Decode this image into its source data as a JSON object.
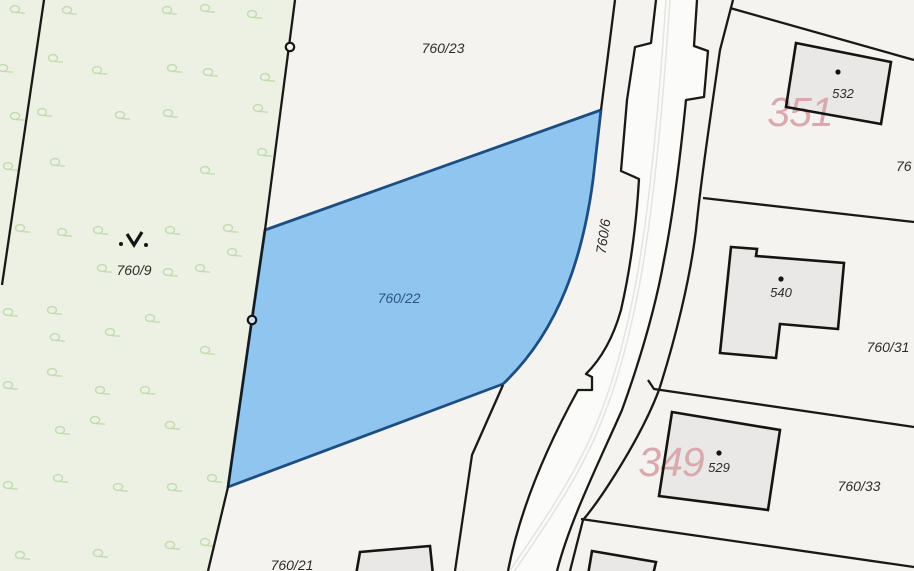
{
  "map": {
    "description": "cadastral parcel map view",
    "selected_parcel": "760/22",
    "colors": {
      "background": "#f4f3f0",
      "forest_fill": "#ecf1e4",
      "forest_symbol": "#c3dbb0",
      "selected_fill": "#8fc5ee",
      "selected_stroke": "#1c4e82",
      "boundary_line": "#191917",
      "building_fill": "#e9e8e6",
      "road_fill": "#fbfbf9",
      "road_centerline": "#e4e4e0",
      "sheet_label_pink": "#d9a9ad",
      "label_black": "#2c2c29",
      "label_blue": "#2e5584"
    },
    "parcels": {
      "p760_23": "760/23",
      "p760_9": "760/9",
      "p760_22": "760/22",
      "p760_6": "760/6",
      "p760_21": "760/21",
      "p760_31": "760/31",
      "p760_33": "760/33",
      "p_edge_cut": "76"
    },
    "buildings": {
      "b532": "532",
      "b540": "540",
      "b529": "529"
    },
    "map_sheets": {
      "s351": "351",
      "s349": "349"
    },
    "vegetation": {
      "meadow_marker": [
        135,
        241
      ],
      "positions": [
        [
          15,
          9
        ],
        [
          67,
          10
        ],
        [
          167,
          10
        ],
        [
          205,
          8
        ],
        [
          252,
          14
        ],
        [
          3,
          68
        ],
        [
          53,
          58
        ],
        [
          97,
          70
        ],
        [
          172,
          68
        ],
        [
          208,
          72
        ],
        [
          265,
          77
        ],
        [
          42,
          112
        ],
        [
          15,
          116
        ],
        [
          120,
          115
        ],
        [
          168,
          113
        ],
        [
          258,
          108
        ],
        [
          8,
          166
        ],
        [
          55,
          162
        ],
        [
          205,
          170
        ],
        [
          262,
          152
        ],
        [
          20,
          228
        ],
        [
          62,
          232
        ],
        [
          98,
          230
        ],
        [
          170,
          230
        ],
        [
          228,
          228
        ],
        [
          102,
          268
        ],
        [
          168,
          272
        ],
        [
          200,
          268
        ],
        [
          232,
          252
        ],
        [
          52,
          310
        ],
        [
          8,
          312
        ],
        [
          110,
          332
        ],
        [
          150,
          318
        ],
        [
          55,
          337
        ],
        [
          52,
          372
        ],
        [
          100,
          390
        ],
        [
          145,
          390
        ],
        [
          8,
          385
        ],
        [
          205,
          350
        ],
        [
          60,
          430
        ],
        [
          95,
          420
        ],
        [
          170,
          425
        ],
        [
          8,
          485
        ],
        [
          58,
          478
        ],
        [
          118,
          487
        ],
        [
          172,
          487
        ],
        [
          212,
          478
        ],
        [
          20,
          555
        ],
        [
          98,
          553
        ],
        [
          170,
          545
        ],
        [
          205,
          542
        ]
      ]
    }
  }
}
